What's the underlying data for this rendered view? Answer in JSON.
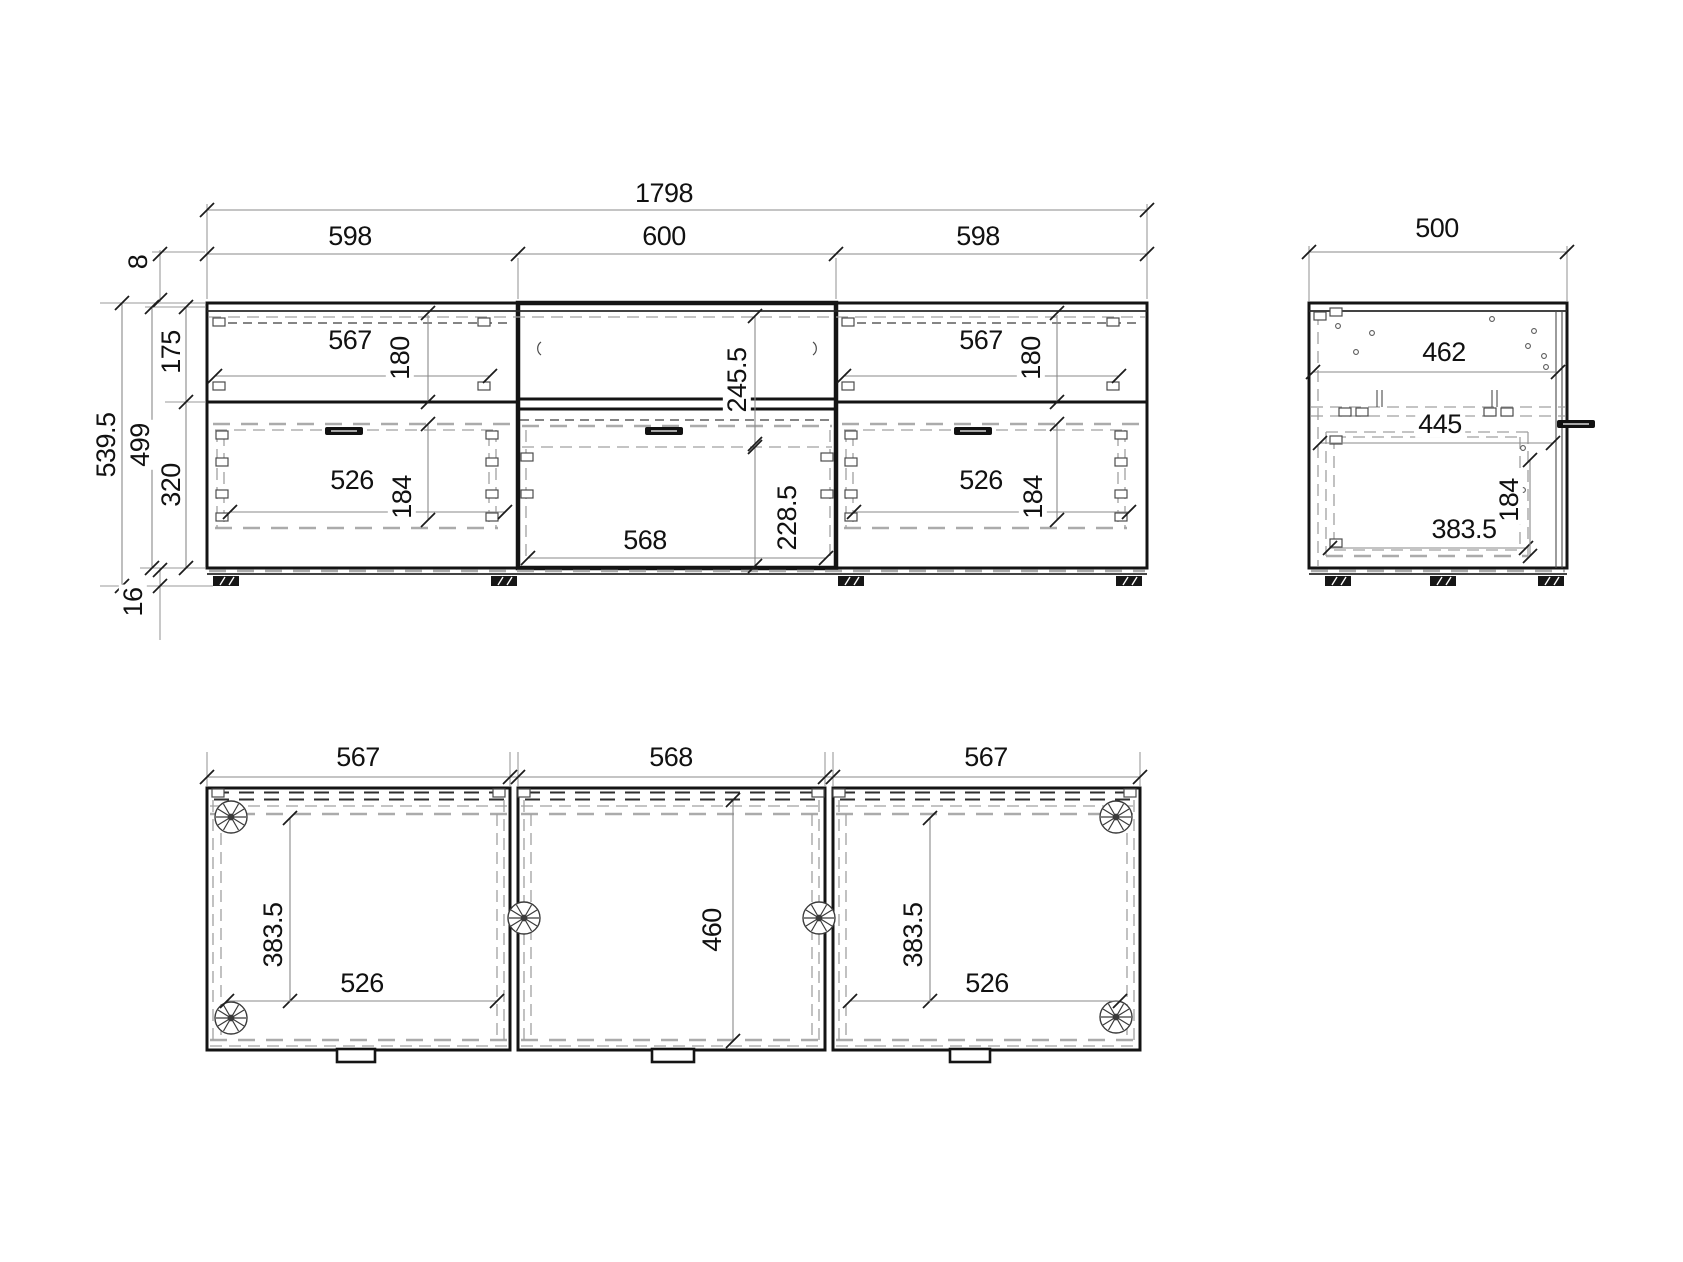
{
  "front": {
    "width_total": "1798",
    "widths": [
      "598",
      "600",
      "598"
    ],
    "height": {
      "top_gap": "8",
      "total": "539.5",
      "carcass": "499",
      "upper": "175",
      "lower": "320",
      "feet": "16"
    },
    "left_module": {
      "drawer_top_w": "567",
      "drawer_top_h": "180",
      "drawer_bot_w": "526",
      "drawer_bot_h": "184"
    },
    "middle_module": {
      "open_h": "245.5",
      "flap_h": "228.5",
      "inner_w": "568"
    },
    "right_module": {
      "drawer_top_w": "567",
      "drawer_top_h": "180",
      "drawer_bot_w": "526",
      "drawer_bot_h": "184"
    }
  },
  "side": {
    "depth": "500",
    "inner_top_w": "462",
    "inner_mid_w": "445",
    "drawer_depth": "383.5",
    "drawer_height": "184"
  },
  "plan": {
    "widths": [
      "567",
      "568",
      "567"
    ],
    "left": {
      "depth": "383.5",
      "width": "526"
    },
    "middle": {
      "inner_depth": "460"
    },
    "right": {
      "depth": "383.5",
      "width": "526"
    }
  }
}
